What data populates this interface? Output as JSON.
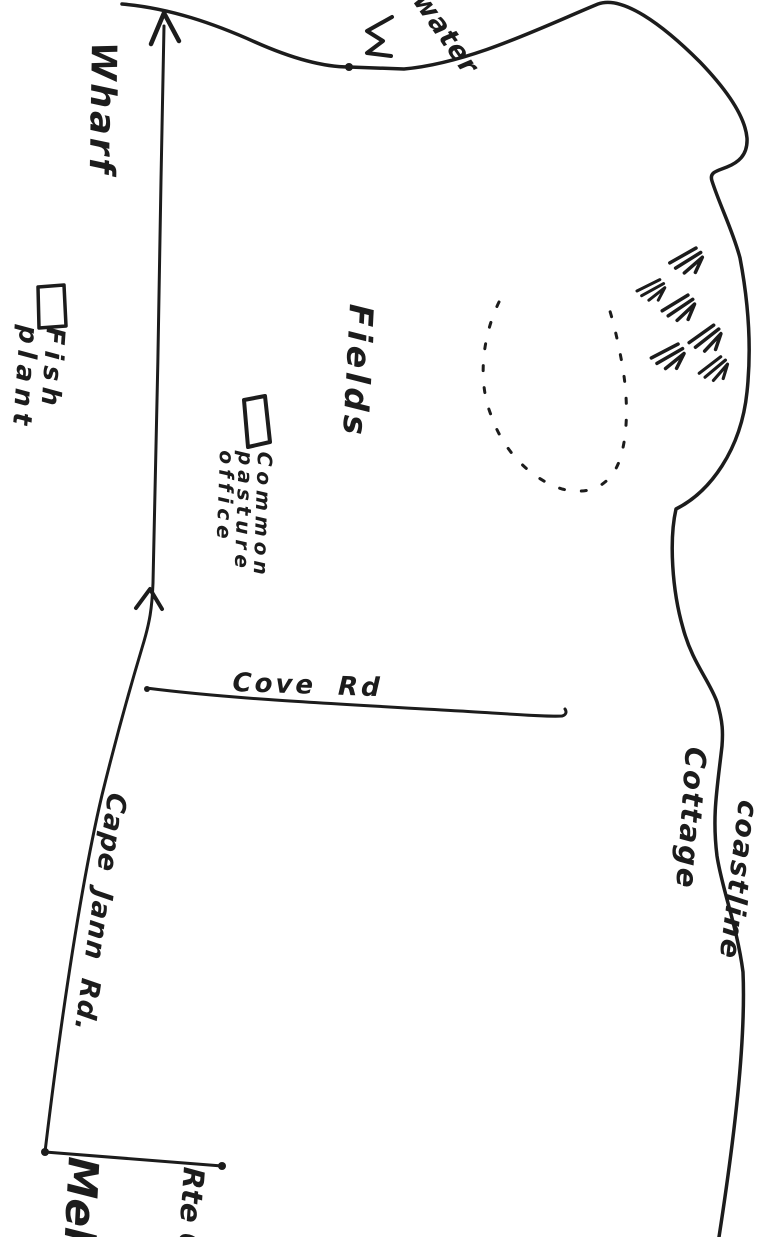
{
  "colors": {
    "paper": "#ffffff",
    "ink": "#1c1c1c"
  },
  "labels": {
    "water": "water",
    "wharf": "Wharf",
    "fish_plant": "Fish\nplant",
    "fields": "Fields",
    "common_pasture_office": "Common\npasture\noffice",
    "cove_rd": "Cove Rd",
    "cottage": "Cottage",
    "coastline": "coastline",
    "cape_jann_rd": "Cape Jann Rd.",
    "meh": "Meh",
    "rte": "Rte 6"
  },
  "symbols": {
    "road_arrowhead": "arrow-up",
    "road_chevron": "chevron-up",
    "wave_mark": "zigzag-wave",
    "shore_dot": "dot",
    "marsh_outline": "dashed-oval",
    "grass_tufts": "grass-hatch-marks",
    "fish_plant_building": "small-rectangle",
    "pasture_office_building": "small-rectangle",
    "boundary_dots": "endpoint-dots"
  }
}
